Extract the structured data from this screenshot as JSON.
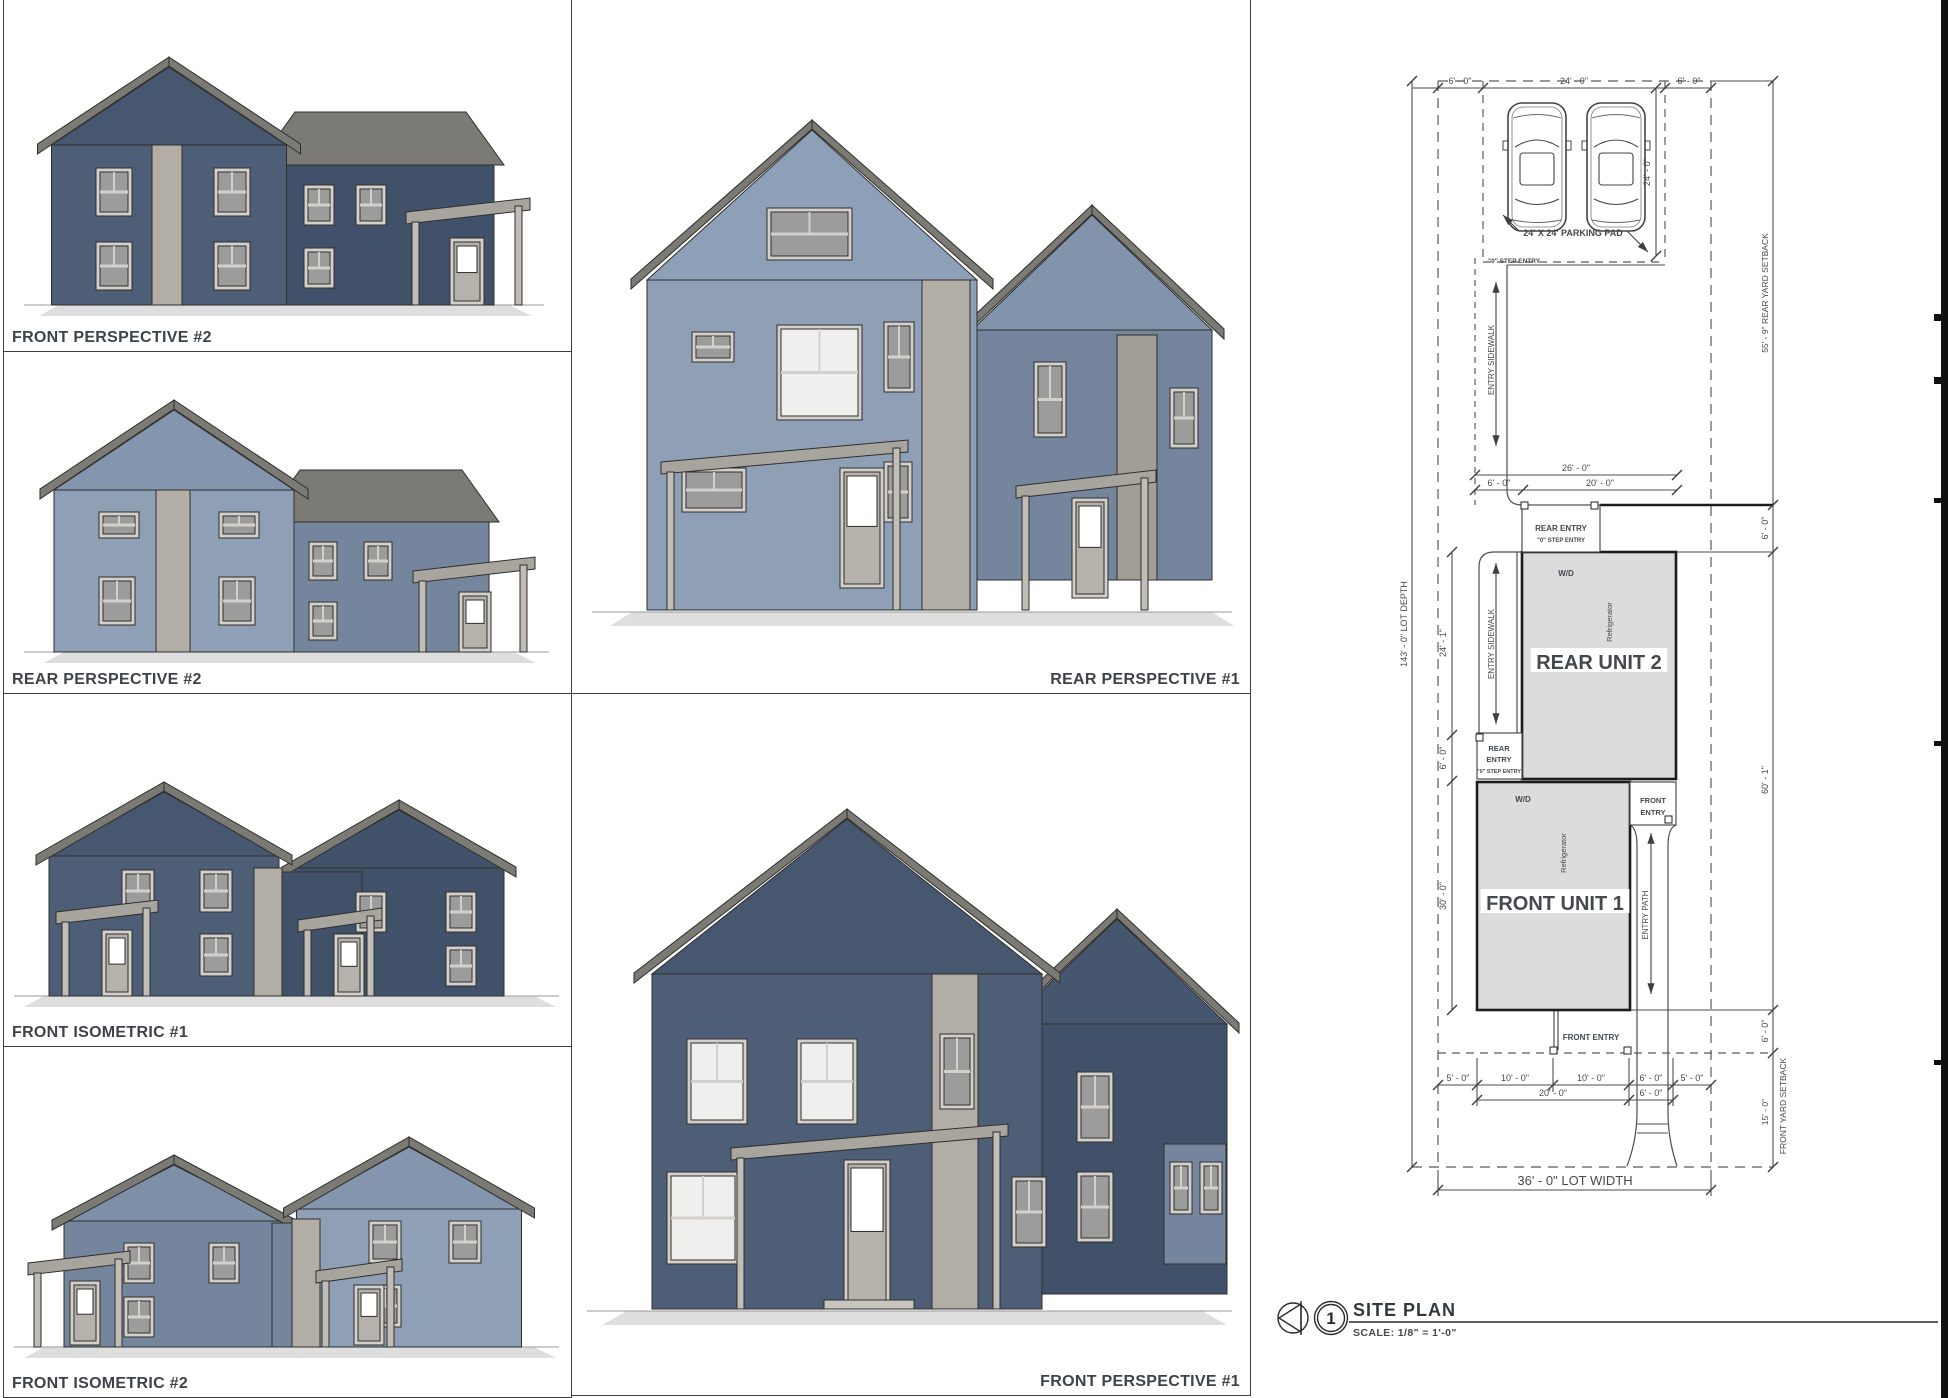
{
  "sheet": {
    "panels": [
      {
        "label": "FRONT PERSPECTIVE #2",
        "align": "left"
      },
      {
        "label": "REAR PERSPECTIVE #2",
        "align": "left"
      },
      {
        "label": "FRONT ISOMETRIC #1",
        "align": "left"
      },
      {
        "label": "FRONT ISOMETRIC #2",
        "align": "left"
      },
      {
        "label": "REAR PERSPECTIVE #1",
        "align": "right"
      },
      {
        "label": "FRONT PERSPECTIVE #1",
        "align": "right"
      }
    ]
  },
  "site_plan": {
    "title": "SITE PLAN",
    "detail_number": "1",
    "scale_text": "SCALE:  1/8\" = 1'-0\"",
    "units": [
      {
        "name": "REAR UNIT 2"
      },
      {
        "name": "FRONT UNIT 1"
      }
    ],
    "annotations": [
      {
        "name": "dim-top-west",
        "text": "6' - 0\"",
        "x": 1460,
        "y": 84,
        "s": 9
      },
      {
        "name": "dim-top-parking",
        "text": "24' - 0\"",
        "x": 1574,
        "y": 84,
        "s": 9
      },
      {
        "name": "dim-top-east",
        "text": "6' - 0\"",
        "x": 1689,
        "y": 84,
        "s": 9
      },
      {
        "name": "dim-parking-depth",
        "text": "24' - 0\"",
        "x": 1650,
        "y": 172,
        "s": 9,
        "r": -90
      },
      {
        "name": "parking-pad-label",
        "text": "24' X 24' PARKING PAD",
        "x": 1573,
        "y": 236,
        "s": 9,
        "b": 1
      },
      {
        "name": "note-step-entry-pad",
        "text": "\"0\" STEP ENTRY",
        "x": 1488,
        "y": 263,
        "s": 6.5,
        "b": 1,
        "a": "start"
      },
      {
        "name": "entry-sidewalk-upper",
        "text": "ENTRY SIDEWALK",
        "x": 1494,
        "y": 360,
        "s": 8,
        "r": -90
      },
      {
        "name": "dim-26",
        "text": "26' - 0\"",
        "x": 1576,
        "y": 471,
        "s": 9
      },
      {
        "name": "dim-6-walk",
        "text": "6' - 0\"",
        "x": 1499,
        "y": 486,
        "s": 9
      },
      {
        "name": "dim-20-rear",
        "text": "20' - 0\"",
        "x": 1600,
        "y": 486,
        "s": 9
      },
      {
        "name": "rear-entry-2-title",
        "text": "REAR ENTRY",
        "x": 1561,
        "y": 531,
        "s": 8,
        "b": 1
      },
      {
        "name": "rear-entry-2-sub",
        "text": "\"0\" STEP ENTRY",
        "x": 1561,
        "y": 542,
        "s": 6,
        "b": 1
      },
      {
        "name": "washer-dryer-rear",
        "text": "W/D",
        "x": 1566,
        "y": 576,
        "s": 8,
        "b": 1
      },
      {
        "name": "refrigerator-rear",
        "text": "Refrigerator",
        "x": 1612,
        "y": 622,
        "s": 7.5,
        "r": -90
      },
      {
        "name": "rear-unit-2-label",
        "text": "REAR UNIT 2",
        "x": 1599,
        "y": 669,
        "s": 20,
        "b": 1,
        "bg": 1
      },
      {
        "name": "dim-24-1",
        "text": "24' - 1\"",
        "x": 1446,
        "y": 643,
        "s": 9,
        "r": -90
      },
      {
        "name": "dim-6-left",
        "text": "6' - 0\"",
        "x": 1446,
        "y": 758,
        "s": 9,
        "r": -90
      },
      {
        "name": "dim-30",
        "text": "30' - 0\"",
        "x": 1446,
        "y": 896,
        "s": 9,
        "r": -90
      },
      {
        "name": "entry-sidewalk-lower",
        "text": "ENTRY SIDEWALK",
        "x": 1494,
        "y": 644,
        "s": 8,
        "r": -90
      },
      {
        "name": "rear-entry-1-a",
        "text": "REAR",
        "x": 1499,
        "y": 751,
        "s": 7.5,
        "b": 1
      },
      {
        "name": "rear-entry-1-b",
        "text": "ENTRY",
        "x": 1499,
        "y": 762,
        "s": 7.5,
        "b": 1
      },
      {
        "name": "rear-entry-1-c",
        "text": "\"0\" STEP ENTRY",
        "x": 1499,
        "y": 773,
        "s": 5.5,
        "b": 1
      },
      {
        "name": "washer-dryer-front",
        "text": "W/D",
        "x": 1523,
        "y": 802,
        "s": 8,
        "b": 1
      },
      {
        "name": "front-entry-2-a",
        "text": "FRONT",
        "x": 1653,
        "y": 803,
        "s": 7.5,
        "b": 1
      },
      {
        "name": "front-entry-2-b",
        "text": "ENTRY",
        "x": 1653,
        "y": 815,
        "s": 7.5,
        "b": 1
      },
      {
        "name": "refrigerator-front",
        "text": "Refrigerator",
        "x": 1566,
        "y": 853,
        "s": 7.5,
        "r": -90
      },
      {
        "name": "front-unit-1-label",
        "text": "FRONT UNIT 1",
        "x": 1555,
        "y": 910,
        "s": 20,
        "b": 1,
        "bg": 1
      },
      {
        "name": "entry-path-label",
        "text": "ENTRY PATH",
        "x": 1648,
        "y": 915,
        "s": 8,
        "r": -90
      },
      {
        "name": "front-entry-1-label",
        "text": "FRONT ENTRY",
        "x": 1591,
        "y": 1040,
        "s": 8,
        "b": 1
      },
      {
        "name": "dim-5-west",
        "text": "5' - 0\"",
        "x": 1458,
        "y": 1081,
        "s": 9
      },
      {
        "name": "dim-10-a",
        "text": "10' - 0\"",
        "x": 1515,
        "y": 1081,
        "s": 9
      },
      {
        "name": "dim-10-b",
        "text": "10' - 0\"",
        "x": 1591,
        "y": 1081,
        "s": 9
      },
      {
        "name": "dim-6-path",
        "text": "6' - 0\"",
        "x": 1651,
        "y": 1081,
        "s": 9
      },
      {
        "name": "dim-5-east",
        "text": "5' - 0\"",
        "x": 1692,
        "y": 1081,
        "s": 9
      },
      {
        "name": "dim-20-front",
        "text": "20' - 0\"",
        "x": 1553,
        "y": 1096,
        "s": 9
      },
      {
        "name": "dim-6-path-2",
        "text": "6' - 0\"",
        "x": 1651,
        "y": 1096,
        "s": 9
      },
      {
        "name": "lot-width-label",
        "text": "36' - 0\" LOT WIDTH",
        "x": 1575,
        "y": 1185,
        "s": 13
      },
      {
        "name": "lot-depth-label",
        "text": "143' - 0\" LOT DEPTH",
        "x": 1407,
        "y": 624,
        "s": 9,
        "r": -90
      },
      {
        "name": "rear-yard-setback",
        "text": "55' - 9\" REAR YARD SETBACK",
        "x": 1768,
        "y": 293,
        "s": 8.5,
        "r": -90
      },
      {
        "name": "dim-6-right-1",
        "text": "6' - 0\"",
        "x": 1768,
        "y": 528,
        "s": 9,
        "r": -90
      },
      {
        "name": "dim-60-1",
        "text": "60' - 1\"",
        "x": 1768,
        "y": 780,
        "s": 9,
        "r": -90
      },
      {
        "name": "dim-6-right-2",
        "text": "6' - 0\"",
        "x": 1768,
        "y": 1031,
        "s": 9,
        "r": -90
      },
      {
        "name": "dim-15",
        "text": "15' - 0\"",
        "x": 1768,
        "y": 1112,
        "s": 8.5,
        "r": -90
      },
      {
        "name": "front-yard-setback",
        "text": "FRONT YARD SETBACK",
        "x": 1786,
        "y": 1106,
        "s": 8.5,
        "r": -90
      }
    ]
  },
  "colors": {
    "siding_dark": "#4e5e76",
    "siding_dark_shade": "#415169",
    "siding_light": "#8fa0b6",
    "siding_light_shade": "#75859d",
    "accent_tan": "#b2ada5",
    "accent_tan_shade": "#a29d95",
    "roof_mid": "#7c7a74",
    "roof_light": "#a8a59e",
    "roof_dark": "#68665f",
    "trim": "#d3d0cb",
    "glass": "#9c9c9c",
    "glass_lit": "#efefed",
    "ink": "#2e2e2c",
    "line": "#4a4f55",
    "unit_fill": "#dcdcdc",
    "shadow": "#dedede"
  }
}
